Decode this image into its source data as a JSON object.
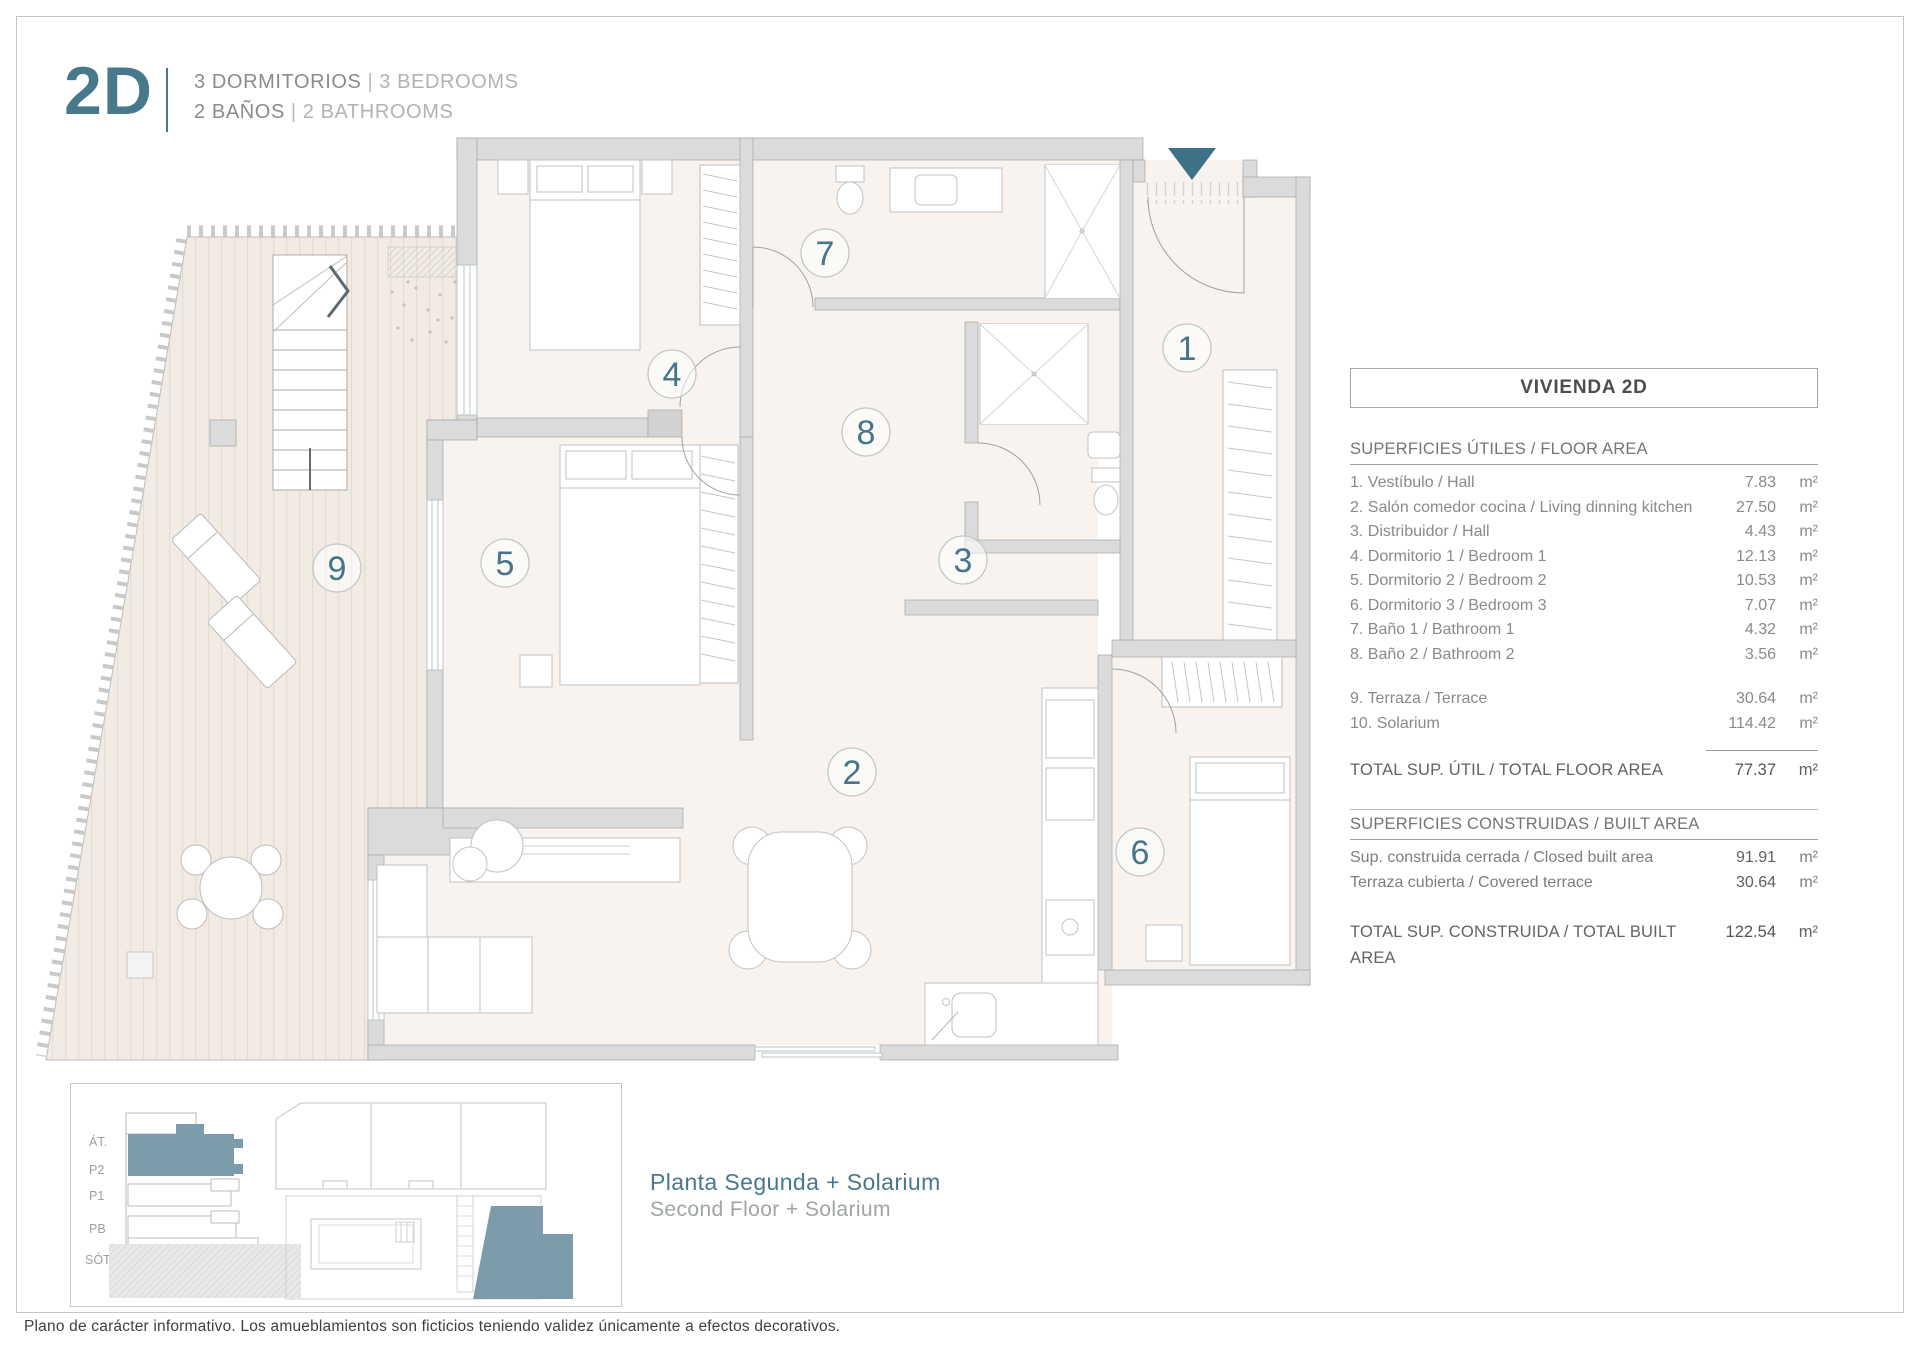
{
  "header": {
    "unit": "2D",
    "rooms_es": "3 DORMITORIOS",
    "rooms_en": "3 BEDROOMS",
    "baths_es": "2 BAÑOS",
    "baths_en": "2 BATHROOMS",
    "sep": "|"
  },
  "plan": {
    "rooms": [
      "1",
      "2",
      "3",
      "4",
      "5",
      "6",
      "7",
      "8",
      "9"
    ],
    "entry_marker_icon": "entry-arrow-icon"
  },
  "table": {
    "title": "VIVIENDA 2D",
    "floor_area": {
      "heading": "SUPERFICIES ÚTILES / FLOOR AREA",
      "rows": [
        {
          "label": "1. Vestíbulo / Hall",
          "value": "7.83",
          "unit": "m²"
        },
        {
          "label": "2. Salón comedor cocina / Living dinning kitchen",
          "value": "27.50",
          "unit": "m²"
        },
        {
          "label": "3. Distribuidor / Hall",
          "value": "4.43",
          "unit": "m²"
        },
        {
          "label": "4. Dormitorio 1 / Bedroom 1",
          "value": "12.13",
          "unit": "m²"
        },
        {
          "label": "5. Dormitorio 2 / Bedroom 2",
          "value": "10.53",
          "unit": "m²"
        },
        {
          "label": "6. Dormitorio 3 / Bedroom 3",
          "value": "7.07",
          "unit": "m²"
        },
        {
          "label": "7. Baño 1 / Bathroom 1",
          "value": "4.32",
          "unit": "m²"
        },
        {
          "label": "8. Baño 2 / Bathroom 2",
          "value": "3.56",
          "unit": "m²"
        }
      ],
      "extra_rows": [
        {
          "label": "9. Terraza / Terrace",
          "value": "30.64",
          "unit": "m²"
        },
        {
          "label": "10. Solarium",
          "value": "114.42",
          "unit": "m²"
        }
      ],
      "total": {
        "label": "TOTAL SUP. ÚTIL / TOTAL FLOOR AREA",
        "value": "77.37",
        "unit": "m²"
      }
    },
    "built_area": {
      "heading": "SUPERFICIES CONSTRUIDAS / BUILT AREA",
      "rows": [
        {
          "label": "Sup. construida cerrada / Closed built area",
          "value": "91.91",
          "unit": "m²"
        },
        {
          "label": "Terraza cubierta / Covered terrace",
          "value": "30.64",
          "unit": "m²"
        }
      ],
      "total": {
        "label": "TOTAL SUP. CONSTRUIDA /  TOTAL BUILT AREA",
        "value": "122.54",
        "unit": "m²"
      }
    }
  },
  "inset": {
    "levels": [
      "ÁT.",
      "P2",
      "P1",
      "PB",
      "SÓT."
    ],
    "caption_es": "Planta Segunda + Solarium",
    "caption_en": "Second Floor + Solarium"
  },
  "footer": {
    "disclaimer": "Plano de carácter informativo. Los amueblamientos son ficticios teniendo validez únicamente a efectos decorativos."
  },
  "colors": {
    "accent": "#47788c",
    "entry_marker": "#3d7186",
    "inset_highlight": "#7c9cab",
    "wall": "#dbdbdb",
    "floor": "#f8f3ee",
    "terrace": "#f1ebe4"
  }
}
